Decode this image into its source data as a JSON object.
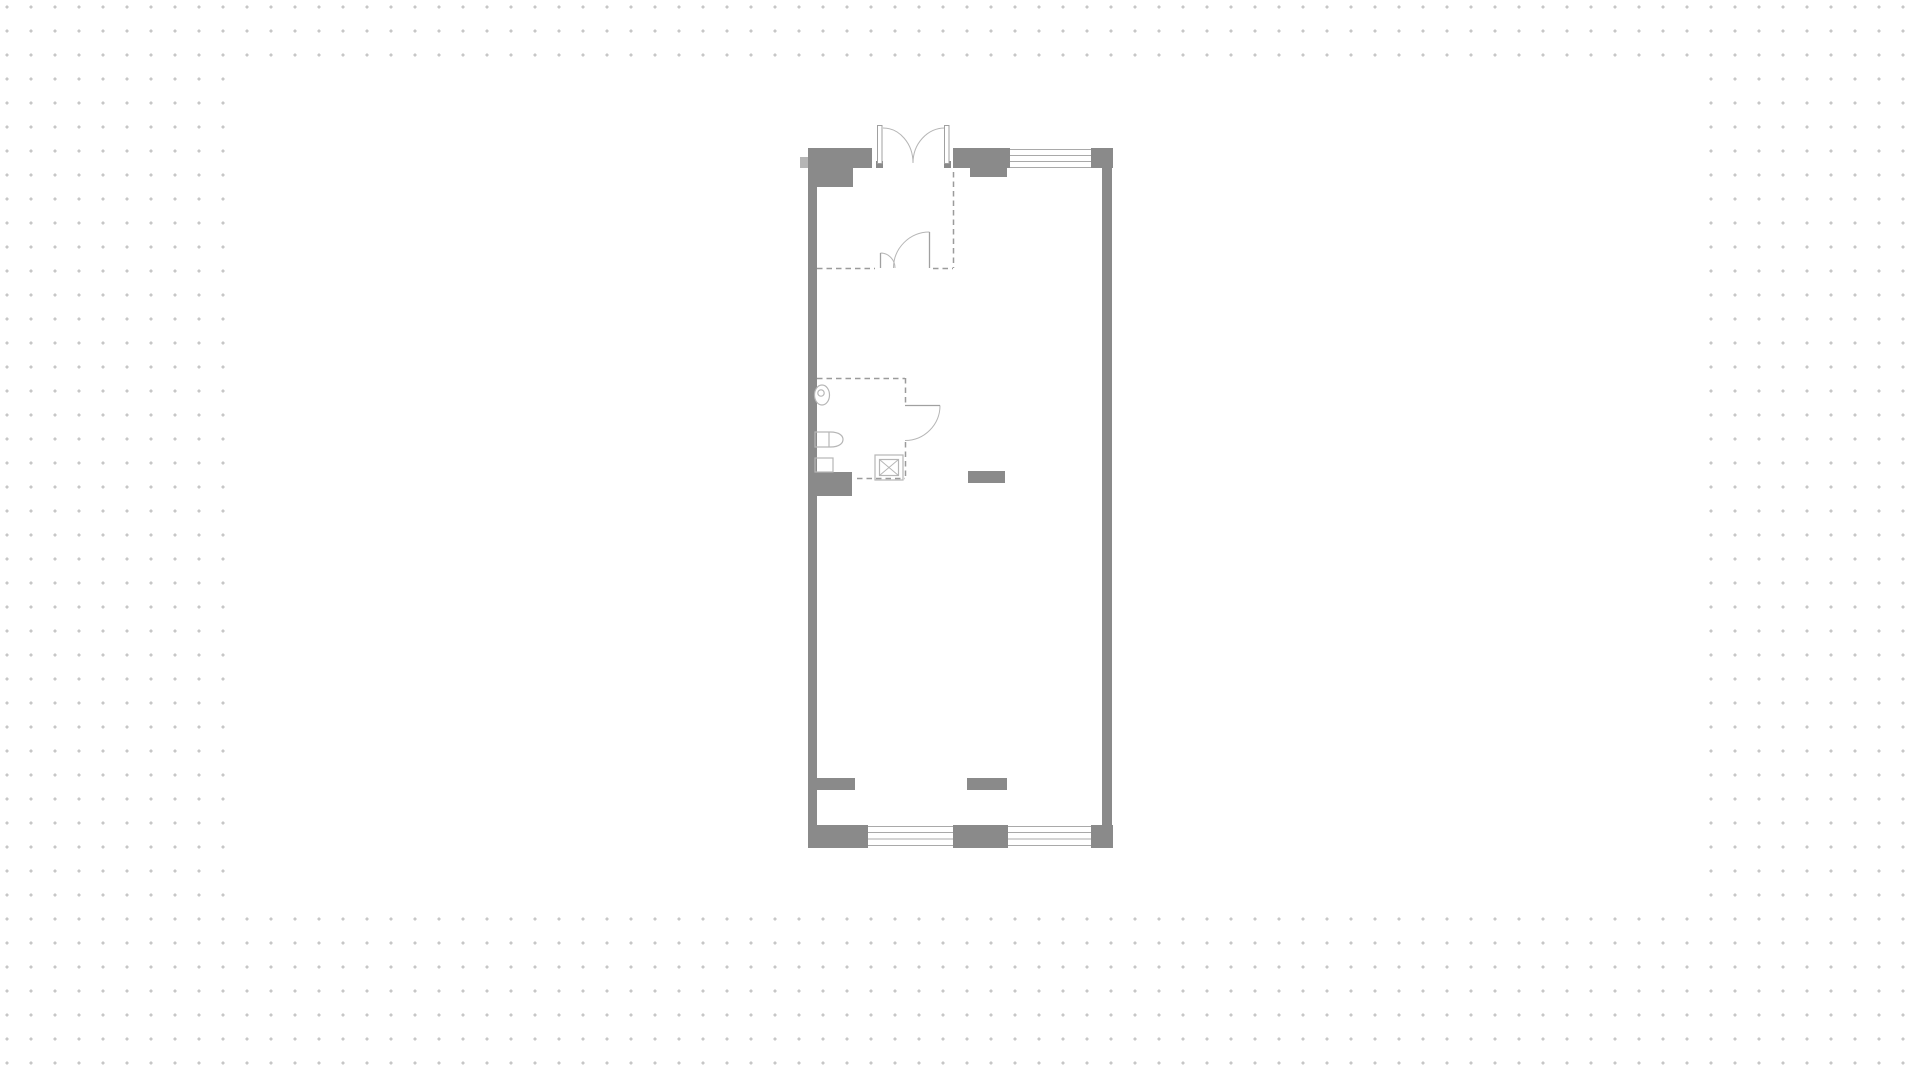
{
  "workspace": {
    "dot_grid": {
      "spacing": 24,
      "dot_size": 3,
      "dot_color": "#c7c7c7",
      "background": "#ffffff"
    },
    "artboard": {
      "x": 232,
      "y": 57,
      "width": 1460,
      "height": 853,
      "fill": "#ffffff"
    }
  },
  "floorplan": {
    "type": "floor-plan",
    "palette": {
      "wall": "#8a8a8a",
      "wall_light": "#b5b5b5",
      "fixture": "#b6b6b6",
      "door": "#a0a0a0",
      "window": "#a9a9a9",
      "dash": "#9b9b9b",
      "white": "#ffffff"
    },
    "viewbox": "780 100 360 770",
    "walls": [
      {
        "x": 808,
        "y": 148,
        "w": 64,
        "h": 20,
        "name": "wall-top-left-block"
      },
      {
        "x": 817,
        "y": 168,
        "w": 36,
        "h": 19,
        "name": "wall-top-left-step"
      },
      {
        "x": 953,
        "y": 148,
        "w": 57,
        "h": 20,
        "name": "wall-top-right-block"
      },
      {
        "x": 970,
        "y": 168,
        "w": 37,
        "h": 9,
        "name": "wall-top-right-step"
      },
      {
        "x": 1091,
        "y": 148,
        "w": 22,
        "h": 20,
        "name": "wall-top-right-corner"
      },
      {
        "x": 808,
        "y": 168,
        "w": 9,
        "h": 657,
        "name": "wall-left"
      },
      {
        "x": 1102,
        "y": 168,
        "w": 10,
        "h": 657,
        "name": "wall-right"
      },
      {
        "x": 808,
        "y": 825,
        "w": 60,
        "h": 23,
        "name": "wall-bottom-left-block"
      },
      {
        "x": 953,
        "y": 825,
        "w": 55,
        "h": 23,
        "name": "wall-bottom-middle-block"
      },
      {
        "x": 1091,
        "y": 825,
        "w": 22,
        "h": 23,
        "name": "wall-bottom-right-corner"
      },
      {
        "x": 815,
        "y": 472,
        "w": 37,
        "h": 15,
        "name": "wall-bath-stub-a"
      },
      {
        "x": 808,
        "y": 487,
        "w": 44,
        "h": 9,
        "name": "wall-bath-stub-b"
      },
      {
        "x": 968,
        "y": 471,
        "w": 37,
        "h": 12,
        "name": "wall-room-stub"
      },
      {
        "x": 817,
        "y": 778,
        "w": 38,
        "h": 12,
        "name": "wall-bottom-stub-left"
      },
      {
        "x": 967,
        "y": 778,
        "w": 40,
        "h": 12,
        "name": "wall-bottom-stub-middle"
      },
      {
        "x": 876,
        "y": 161,
        "w": 7,
        "h": 7,
        "name": "entry-door-jamb-left"
      },
      {
        "x": 944,
        "y": 161,
        "w": 7,
        "h": 7,
        "name": "entry-door-jamb-right"
      }
    ],
    "light_walls": [
      {
        "x": 800,
        "y": 157,
        "w": 8,
        "h": 11,
        "name": "wall-outer-ledge"
      }
    ],
    "window_lines": [
      {
        "x1": 1010,
        "y1": 149.5,
        "x2": 1091,
        "y2": 149.5,
        "name": "window-top-line"
      },
      {
        "x1": 1010,
        "y1": 155.5,
        "x2": 1091,
        "y2": 155.5,
        "name": "window-top-line"
      },
      {
        "x1": 1010,
        "y1": 161.5,
        "x2": 1091,
        "y2": 161.5,
        "name": "window-top-line"
      },
      {
        "x1": 1010,
        "y1": 167.5,
        "x2": 1091,
        "y2": 167.5,
        "name": "window-top-line"
      },
      {
        "x1": 868,
        "y1": 826.5,
        "x2": 953,
        "y2": 826.5,
        "name": "window-bottom-a-line"
      },
      {
        "x1": 868,
        "y1": 832.5,
        "x2": 953,
        "y2": 832.5,
        "name": "window-bottom-a-line"
      },
      {
        "x1": 868,
        "y1": 839,
        "x2": 953,
        "y2": 839,
        "name": "window-bottom-a-line"
      },
      {
        "x1": 868,
        "y1": 845.5,
        "x2": 953,
        "y2": 845.5,
        "name": "window-bottom-a-line"
      },
      {
        "x1": 1008,
        "y1": 826.5,
        "x2": 1091,
        "y2": 826.5,
        "name": "window-bottom-b-line"
      },
      {
        "x1": 1008,
        "y1": 832.5,
        "x2": 1091,
        "y2": 832.5,
        "name": "window-bottom-b-line"
      },
      {
        "x1": 1008,
        "y1": 839,
        "x2": 1091,
        "y2": 839,
        "name": "window-bottom-b-line"
      },
      {
        "x1": 1008,
        "y1": 845.5,
        "x2": 1091,
        "y2": 845.5,
        "name": "window-bottom-b-line"
      }
    ],
    "dashed_lines": [
      {
        "x1": 953.5,
        "y1": 172,
        "x2": 953.5,
        "y2": 268,
        "name": "vestibule-dash-right"
      },
      {
        "x1": 817,
        "y1": 268.5,
        "x2": 875,
        "y2": 268.5,
        "name": "vestibule-dash-bottom-left"
      },
      {
        "x1": 933,
        "y1": 268.5,
        "x2": 953,
        "y2": 268.5,
        "name": "vestibule-dash-bottom-right"
      },
      {
        "x1": 817,
        "y1": 378.5,
        "x2": 905,
        "y2": 378.5,
        "name": "bathroom-dash-top"
      },
      {
        "x1": 905.5,
        "y1": 378,
        "x2": 905.5,
        "y2": 405,
        "name": "bathroom-dash-right-upper"
      },
      {
        "x1": 905.5,
        "y1": 442,
        "x2": 905.5,
        "y2": 478,
        "name": "bathroom-dash-right-lower"
      },
      {
        "x1": 857,
        "y1": 478.5,
        "x2": 905,
        "y2": 478.5,
        "name": "bathroom-dash-bottom"
      }
    ],
    "door_leaf_rects": [
      {
        "x": 877.5,
        "y": 125.5,
        "w": 4.5,
        "h": 38,
        "name": "entry-door-leaf-left"
      },
      {
        "x": 944.5,
        "y": 125.5,
        "w": 4.5,
        "h": 38,
        "name": "entry-door-leaf-right"
      }
    ],
    "door_lines": [
      {
        "x1": 880.5,
        "y1": 253,
        "x2": 880.5,
        "y2": 268,
        "name": "inner-door-leaf-small"
      },
      {
        "x1": 929.5,
        "y1": 232,
        "x2": 929.5,
        "y2": 268,
        "name": "inner-door-leaf-large"
      },
      {
        "x1": 905,
        "y1": 405.5,
        "x2": 940,
        "y2": 405.5,
        "name": "bathroom-door-leaf"
      }
    ],
    "swing_arcs": [
      {
        "d": "M 883 128 A 30 35 0 0 1 913 163",
        "name": "entry-door-swing-left"
      },
      {
        "d": "M 945 128 A 32 35 0 0 0 913 163",
        "name": "entry-door-swing-right"
      },
      {
        "d": "M 880.5 253 A 14.5 15 0 0 1 895 268",
        "name": "inner-door-swing-small"
      },
      {
        "d": "M 929.5 232 A 36 36 0 0 0 893.5 268",
        "name": "inner-door-swing-large"
      },
      {
        "d": "M 940 405.5 A 35 35 0 0 1 905 440.5",
        "name": "bathroom-door-swing"
      }
    ],
    "fixture_paths": [
      {
        "d": "M 815 432 H 830 C 840.5 432 843 436.5 843 439.5 C 843 442.5 840.5 447 830 447 H 815 Z",
        "name": "sink-fixture"
      },
      {
        "d": "M 829 432 V 447",
        "name": "sink-divider"
      }
    ],
    "fixture_rects": [
      {
        "x": 815,
        "y": 458,
        "w": 18,
        "h": 14,
        "name": "bath-counter"
      },
      {
        "x": 875,
        "y": 455,
        "w": 28,
        "h": 25,
        "name": "shower-outer"
      },
      {
        "x": 879.5,
        "y": 459.5,
        "w": 19,
        "h": 16,
        "name": "shower-inner"
      }
    ],
    "fixture_lines": [
      {
        "x1": 879.5,
        "y1": 459.5,
        "x2": 898.5,
        "y2": 475.5,
        "name": "shower-x-line"
      },
      {
        "x1": 898.5,
        "y1": 459.5,
        "x2": 879.5,
        "y2": 475.5,
        "name": "shower-x-line"
      }
    ],
    "ellipses": [
      {
        "cx": 822,
        "cy": 395,
        "rx": 7.5,
        "ry": 10,
        "name": "toilet-bowl"
      },
      {
        "cx": 821,
        "cy": 393,
        "rx": 3.2,
        "ry": 3.2,
        "name": "toilet-flush"
      }
    ]
  }
}
